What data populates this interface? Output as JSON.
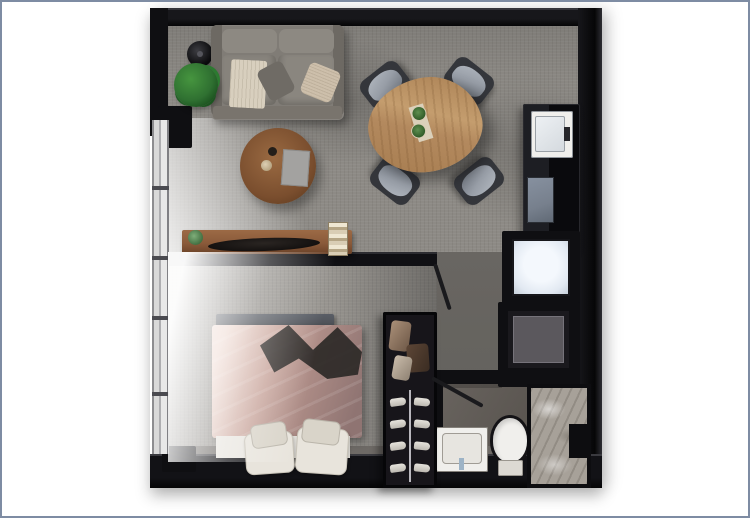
{
  "page": {
    "kind": "apartment-floor-plan-render",
    "background": "#ffffff"
  },
  "colors": {
    "frame_border": "#7e8ca3",
    "wall": "#0f0f12",
    "wall_highlight": "#35353b",
    "floor_living": "#8d8a85",
    "floor_bedroom": "#97948f",
    "floor_corridor": "#7b7873",
    "floor_bath": "#5a5550",
    "shower_stone": "#a7a199",
    "window_glass": "#d9d9d9",
    "sofa_gray": "#807c76",
    "cushion_gray": "#8d8982",
    "throw_cream": "#d8cfbe",
    "wood_walnut": "#8a5a3a",
    "wood_oak": "#b3895e",
    "wood_coffee": "#7a4e2e",
    "duvet_pink": "#c9a69d",
    "duvet_shadow": "#8f7472",
    "bench_slate": "#4c4f55",
    "linen_white": "#e9e6e0",
    "fixture_white": "#f0efec",
    "appliance_glow": "#e2e9f2",
    "appliance_gray": "#5b585d",
    "cooktop_gray": "#77808d",
    "chair_charcoal": "#34363b",
    "chair_seat": "#979da6",
    "plant_green": "#2f7031",
    "lamp_black": "#0a0a0c"
  },
  "rooms": [
    {
      "name": "living-dining-area"
    },
    {
      "name": "kitchen"
    },
    {
      "name": "bedroom"
    },
    {
      "name": "bathroom"
    },
    {
      "name": "laundry-nook"
    }
  ],
  "furniture": [
    "sofa",
    "floor-lamp",
    "potted-plant",
    "round-coffee-table",
    "dining-table",
    "dining-chairs-x4",
    "console-table",
    "kitchen-counter",
    "kitchen-sink",
    "cooktop",
    "washer-white",
    "dryer-gray",
    "wardrobe-with-shoe-rack",
    "double-bed",
    "foot-bench",
    "bathroom-sink",
    "toilet",
    "walk-in-shower",
    "left-window-wall",
    "interior-doors-x2"
  ]
}
